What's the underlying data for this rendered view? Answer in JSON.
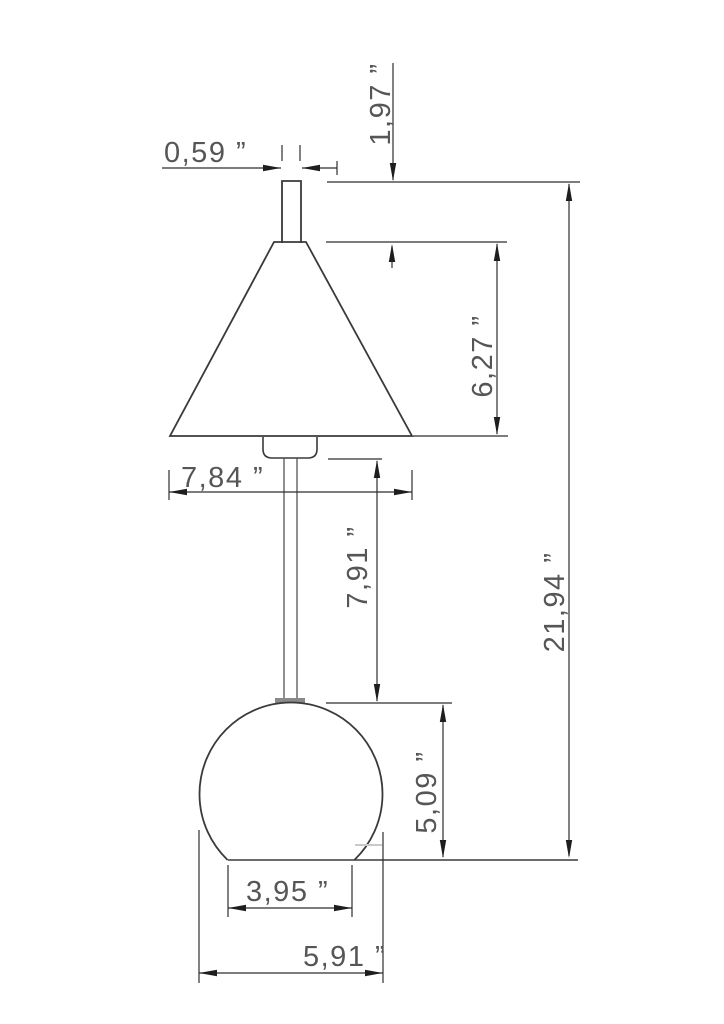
{
  "drawing": {
    "type": "technical-dimension-drawing",
    "subject": "cone-shade table lamp with spherical base, front elevation",
    "unit_symbol": "”",
    "decimal_style": "comma",
    "colors": {
      "background": "#ffffff",
      "outline": "#3a3a3a",
      "dimension_lines": "#2e2e2e",
      "dimension_text": "#565656",
      "flange": "#8a8a8a"
    },
    "dimensions": {
      "finial_width": {
        "label": "0,59 ”",
        "value": 0.59,
        "measures": "top rod width"
      },
      "finial_height": {
        "label": "1,97 ”",
        "value": 1.97,
        "measures": "top rod height"
      },
      "shade_height": {
        "label": "6,27 ”",
        "value": 6.27,
        "measures": "cone shade height"
      },
      "shade_diameter": {
        "label": "7,84 ”",
        "value": 7.84,
        "measures": "cone shade diameter"
      },
      "stem_length": {
        "label": "7,91 ”",
        "value": 7.91,
        "measures": "stem length"
      },
      "base_height": {
        "label": "5,09 ”",
        "value": 5.09,
        "measures": "sphere base height"
      },
      "total_height": {
        "label": "21,94 ”",
        "value": 21.94,
        "measures": "total lamp height"
      },
      "base_flat_width": {
        "label": "3,95 ”",
        "value": 3.95,
        "measures": "flat bottom width"
      },
      "base_diameter": {
        "label": "5,91 ”",
        "value": 5.91,
        "measures": "sphere base diameter"
      }
    }
  }
}
